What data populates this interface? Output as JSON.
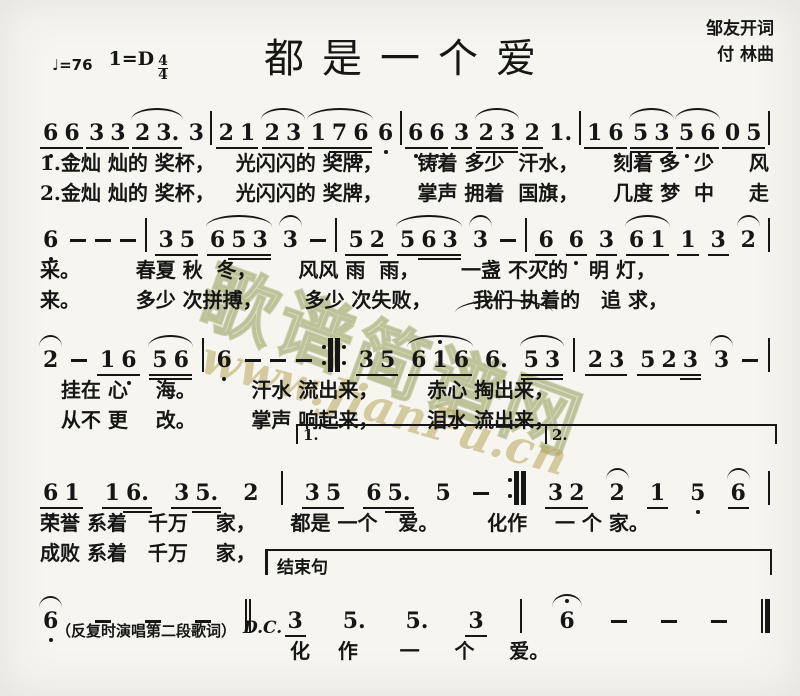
{
  "header": {
    "tempo_glyph": "♩",
    "tempo_value": "=76",
    "key_signature": "1=D",
    "time_numerator": "4",
    "time_denominator": "4",
    "title": "都是一个爱",
    "lyricist": "邹友开词",
    "composer": "付  林曲"
  },
  "watermark": {
    "site_cjk": "歌谱简谱网",
    "site_url": "www.JianPu.cn",
    "color": "#a9b272"
  },
  "annotations": {
    "volta1": "1.",
    "volta2": "2.",
    "coda": "结束句",
    "repeat_note": "（反复时演唱第二段歌词）",
    "dc": "D.C."
  },
  "systems": [
    {
      "tokens": [
        {
          "k": "group",
          "notes": [
            {
              "t": "6",
              "u": 1,
              "lo": 1
            },
            {
              "t": "6",
              "u": 1,
              "lo": 1
            }
          ]
        },
        {
          "k": "group",
          "notes": [
            {
              "t": "3",
              "u": 1
            },
            {
              "t": "3",
              "u": 1
            }
          ]
        },
        {
          "k": "group",
          "slur": true,
          "notes": [
            {
              "t": "2",
              "u": 1
            },
            {
              "t": "3.",
              "u": 1
            }
          ]
        },
        {
          "k": "note",
          "t": "3"
        },
        {
          "k": "bar"
        },
        {
          "k": "group",
          "notes": [
            {
              "t": "2",
              "u": 1
            },
            {
              "t": "1",
              "u": 1
            }
          ]
        },
        {
          "k": "group",
          "slur": true,
          "notes": [
            {
              "t": "2",
              "u": 1
            },
            {
              "t": "3",
              "u": 1
            }
          ]
        },
        {
          "k": "group",
          "slur": true,
          "notes": [
            {
              "t": "1",
              "u": 1
            },
            {
              "t": "7",
              "u": 2,
              "lo": 1
            },
            {
              "t": "6",
              "u": 2,
              "lo": 1
            }
          ]
        },
        {
          "k": "note",
          "t": "6",
          "lo": 1
        },
        {
          "k": "bar"
        },
        {
          "k": "group",
          "notes": [
            {
              "t": "6",
              "u": 1,
              "lo": 1
            },
            {
              "t": "6",
              "u": 1,
              "lo": 1
            }
          ]
        },
        {
          "k": "note",
          "t": "3",
          "u": 1
        },
        {
          "k": "group",
          "slur": true,
          "notes": [
            {
              "t": "2",
              "u": 2
            },
            {
              "t": "3",
              "u": 2
            }
          ]
        },
        {
          "k": "note",
          "t": "2",
          "u": 1
        },
        {
          "k": "note",
          "t": "1."
        },
        {
          "k": "bar"
        },
        {
          "k": "group",
          "notes": [
            {
              "t": "1",
              "u": 1
            },
            {
              "t": "6",
              "u": 1,
              "lo": 1
            }
          ]
        },
        {
          "k": "group",
          "slur": true,
          "notes": [
            {
              "t": "5",
              "u": 2,
              "lo": 1
            },
            {
              "t": "3",
              "u": 2,
              "lo": 1
            }
          ]
        },
        {
          "k": "group",
          "slur": true,
          "notes": [
            {
              "t": "5",
              "u": 1,
              "lo": 1
            },
            {
              "t": "6",
              "u": 1,
              "lo": 1
            }
          ]
        },
        {
          "k": "group",
          "notes": [
            {
              "t": "0",
              "u": 1
            },
            {
              "t": "5",
              "u": 1,
              "lo": 1
            }
          ]
        },
        {
          "k": "bar"
        }
      ],
      "lyrics": [
        "1.金灿 灿的 奖杯，   光闪闪的 奖牌，     铸着 多少  汗水，     刻着 多  少     风",
        "2.金灿 灿的 奖杯，   光闪闪的 奖牌，     掌声 拥着  国旗，     几度 梦  中     走"
      ]
    },
    {
      "tokens": [
        {
          "k": "note",
          "t": "6",
          "lo": 1
        },
        {
          "k": "dash"
        },
        {
          "k": "dash"
        },
        {
          "k": "dash"
        },
        {
          "k": "bar"
        },
        {
          "k": "group",
          "notes": [
            {
              "t": "3",
              "u": 1
            },
            {
              "t": "5",
              "u": 1
            }
          ]
        },
        {
          "k": "group",
          "slur": true,
          "notes": [
            {
              "t": "6",
              "u": 1
            },
            {
              "t": "5",
              "u": 2
            },
            {
              "t": "3",
              "u": 2
            }
          ]
        },
        {
          "k": "note",
          "t": "3",
          "slur": true
        },
        {
          "k": "dash"
        },
        {
          "k": "bar"
        },
        {
          "k": "group",
          "notes": [
            {
              "t": "5",
              "u": 1
            },
            {
              "t": "2",
              "u": 1
            }
          ]
        },
        {
          "k": "group",
          "slur": true,
          "notes": [
            {
              "t": "5",
              "u": 1
            },
            {
              "t": "6",
              "u": 2
            },
            {
              "t": "3",
              "u": 2
            }
          ]
        },
        {
          "k": "note",
          "t": "3",
          "slur": true
        },
        {
          "k": "dash"
        },
        {
          "k": "bar"
        },
        {
          "k": "note",
          "t": "6",
          "u": 1,
          "lo": 1
        },
        {
          "k": "note",
          "t": "6",
          "u": 1,
          "lo": 1
        },
        {
          "k": "note",
          "t": "3",
          "u": 1
        },
        {
          "k": "group",
          "slur": true,
          "notes": [
            {
              "t": "6",
              "u": 1
            },
            {
              "t": "1",
              "u": 1
            }
          ]
        },
        {
          "k": "note",
          "t": "1",
          "u": 1
        },
        {
          "k": "note",
          "t": "3",
          "u": 1
        },
        {
          "k": "note",
          "t": "2",
          "slur": true
        },
        {
          "k": "bar"
        }
      ],
      "lyrics": [
        "采。        春夏 秋  冬，      风风 雨  雨，      一盏 不灭的   明 灯，",
        "来。        多少 次拼搏，      多少 次失败，      我们 执着的   追 求，"
      ]
    },
    {
      "tokens": [
        {
          "k": "note",
          "t": "2",
          "slur": true
        },
        {
          "k": "dash"
        },
        {
          "k": "group",
          "notes": [
            {
              "t": "1",
              "u": 1
            },
            {
              "t": "6",
              "u": 1,
              "lo": 1
            }
          ]
        },
        {
          "k": "group",
          "slur": true,
          "notes": [
            {
              "t": "5",
              "u": 2
            },
            {
              "t": "6",
              "u": 2
            }
          ]
        },
        {
          "k": "bar"
        },
        {
          "k": "note",
          "t": "6",
          "lo": 1
        },
        {
          "k": "dash"
        },
        {
          "k": "dash"
        },
        {
          "k": "dash"
        },
        {
          "k": "bar",
          "style": "repeat-both"
        },
        {
          "k": "group",
          "notes": [
            {
              "t": "3",
              "u": 1
            },
            {
              "t": "5",
              "u": 1
            }
          ]
        },
        {
          "k": "group",
          "slur": true,
          "notes": [
            {
              "t": "6",
              "u": 1
            },
            {
              "t": "1",
              "u": 1,
              "hi": 1
            },
            {
              "t": "6",
              "u": 1
            }
          ]
        },
        {
          "k": "note",
          "t": "6."
        },
        {
          "k": "group",
          "slur": true,
          "notes": [
            {
              "t": "5",
              "u": 2
            },
            {
              "t": "3",
              "u": 2
            }
          ]
        },
        {
          "k": "bar"
        },
        {
          "k": "group",
          "notes": [
            {
              "t": "2",
              "u": 1
            },
            {
              "t": "3",
              "u": 1
            }
          ]
        },
        {
          "k": "group",
          "notes": [
            {
              "t": "5",
              "u": 1
            },
            {
              "t": "2",
              "u": 1
            },
            {
              "t": "3",
              "u": 2
            }
          ]
        },
        {
          "k": "note",
          "t": "3",
          "slur": true
        },
        {
          "k": "dash"
        },
        {
          "k": "bar"
        }
      ],
      "lyrics": [
        "   挂在 心    海。        汗水 流出来，       赤心 掏出来，",
        "   从不 更    改。        掌声 响起来，       泪水 流出来，"
      ]
    },
    {
      "tokens": [
        {
          "k": "group",
          "notes": [
            {
              "t": "6",
              "u": 1,
              "lo": 1
            },
            {
              "t": "1",
              "u": 1
            }
          ]
        },
        {
          "k": "group",
          "notes": [
            {
              "t": "1",
              "u": 1
            },
            {
              "t": "6.",
              "u": 2
            }
          ]
        },
        {
          "k": "group",
          "notes": [
            {
              "t": "3",
              "u": 1
            },
            {
              "t": "5.",
              "u": 2
            }
          ]
        },
        {
          "k": "note",
          "t": "2"
        },
        {
          "k": "bar"
        },
        {
          "k": "group",
          "notes": [
            {
              "t": "3",
              "u": 1
            },
            {
              "t": "5",
              "u": 1
            }
          ]
        },
        {
          "k": "group",
          "notes": [
            {
              "t": "6",
              "u": 1
            },
            {
              "t": "5.",
              "u": 2
            }
          ]
        },
        {
          "k": "note",
          "t": "5"
        },
        {
          "k": "dash"
        },
        {
          "k": "bar",
          "style": "repeat-end"
        },
        {
          "k": "group",
          "notes": [
            {
              "t": "3",
              "u": 1
            },
            {
              "t": "2",
              "u": 1
            }
          ]
        },
        {
          "k": "note",
          "t": "2",
          "slur": true
        },
        {
          "k": "note",
          "t": "1",
          "u": 1
        },
        {
          "k": "note",
          "t": "5",
          "lo": 1
        },
        {
          "k": "note",
          "t": "6",
          "u": 1,
          "slur": true
        },
        {
          "k": "bar"
        }
      ],
      "lyrics": [
        "荣誉 系着   千万    家，     都是 一个   爱。       化作    一 个 家。",
        "成败 系着   千万    家，"
      ]
    },
    {
      "tokens": [
        {
          "k": "note",
          "t": "6",
          "lo": 1,
          "slur": true
        },
        {
          "k": "dash"
        },
        {
          "k": "dash"
        },
        {
          "k": "dash"
        },
        {
          "k": "bar",
          "style": "double"
        },
        {
          "k": "note",
          "t": "3",
          "u": 1
        },
        {
          "k": "note",
          "t": "5."
        },
        {
          "k": "note",
          "t": "5."
        },
        {
          "k": "note",
          "t": "3",
          "u": 1
        },
        {
          "k": "bar"
        },
        {
          "k": "note",
          "t": "6",
          "fermata": true
        },
        {
          "k": "dash"
        },
        {
          "k": "dash"
        },
        {
          "k": "dash"
        },
        {
          "k": "bar",
          "style": "final"
        }
      ],
      "lyrics": [
        "化    作      一     个     爱。"
      ]
    }
  ]
}
